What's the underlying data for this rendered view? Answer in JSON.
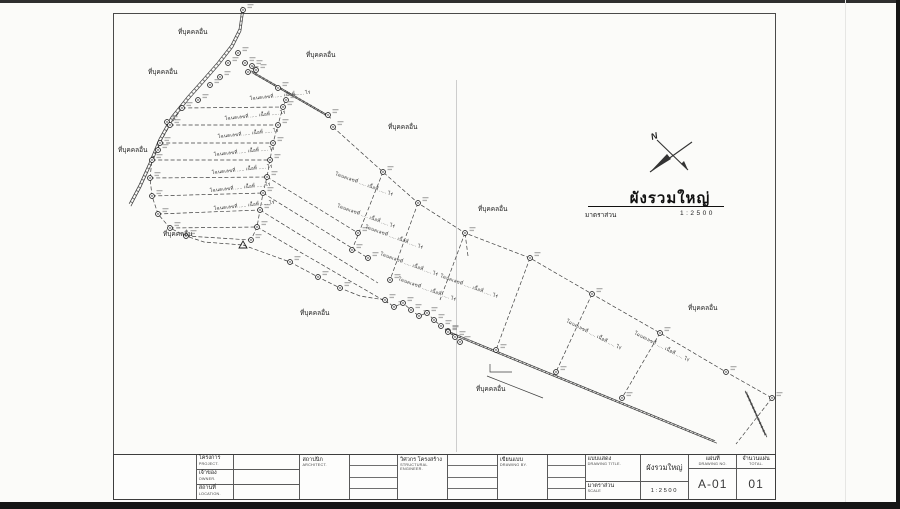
{
  "sheet": {
    "drawing_title": "ผังรวมใหญ่",
    "scale_label": "มาตราส่วน",
    "scale_value": "1:2500",
    "north_label": "N"
  },
  "titleblock": {
    "project_th": "โครงการ",
    "project_en": "PROJECT.",
    "project_value": "",
    "owner_th": "เจ้าของ",
    "owner_en": "OWNER.",
    "owner_value": "",
    "location_th": "สถานที่",
    "location_en": "LOCATION.",
    "location_value": "",
    "architect_th": "สถาปนิก",
    "architect_en": "ARCHITECT.",
    "structural_th": "วิศวกร โครงสร้าง",
    "structural_en": "STRUCTURAL ENGINEER.",
    "drawn_by_th": "เขียนแบบ",
    "drawn_by_en": "DRAWING BY.",
    "drawing_title_th": "แบบแสดง",
    "drawing_title_en": "DRAWING TITLE.",
    "drawing_title_value": "ผังรวมใหญ่",
    "scale_th": "มาตราส่วน",
    "scale_en": "SCALE",
    "scale_value": "1:2500",
    "sheet_no_th": "แผ่นที่",
    "sheet_no_en": "DRAWING NO.",
    "sheet_no_value": "A-01",
    "total_th": "จำนวนแผ่น",
    "total_en": "TOTAL.",
    "total_value": "01"
  },
  "plan": {
    "adjacent_land_label": "ที่บุคคลอื่น",
    "parcel_label_text": "โฉนดเลขที่ ..... เนื้อที่ ..... ไร่",
    "area_labels": [
      [
        178,
        34
      ],
      [
        306,
        57
      ],
      [
        148,
        74
      ],
      [
        118,
        152
      ],
      [
        388,
        129
      ],
      [
        478,
        211
      ],
      [
        163,
        236
      ],
      [
        300,
        315
      ],
      [
        688,
        310
      ],
      [
        476,
        391
      ]
    ],
    "parcel_labels": [
      [
        250,
        100,
        -6
      ],
      [
        225,
        120,
        -6
      ],
      [
        218,
        138,
        -6
      ],
      [
        214,
        156,
        -6
      ],
      [
        212,
        174,
        -6
      ],
      [
        210,
        192,
        -6
      ],
      [
        214,
        210,
        -6
      ],
      [
        335,
        175,
        20
      ],
      [
        337,
        207,
        20
      ],
      [
        365,
        228,
        20
      ],
      [
        380,
        255,
        20
      ],
      [
        398,
        280,
        20
      ],
      [
        440,
        277,
        20
      ],
      [
        566,
        322,
        27
      ],
      [
        634,
        334,
        27
      ]
    ],
    "markers": [
      [
        245,
        63
      ],
      [
        252,
        66
      ],
      [
        248,
        72
      ],
      [
        256,
        70
      ],
      [
        238,
        53
      ],
      [
        228,
        63
      ],
      [
        220,
        77
      ],
      [
        210,
        85
      ],
      [
        198,
        100
      ],
      [
        182,
        108
      ],
      [
        167,
        122
      ],
      [
        158,
        150
      ],
      [
        170,
        125
      ],
      [
        160,
        143
      ],
      [
        152,
        160
      ],
      [
        150,
        178
      ],
      [
        152,
        196
      ],
      [
        158,
        214
      ],
      [
        170,
        228
      ],
      [
        186,
        236
      ],
      [
        286,
        100
      ],
      [
        283,
        107
      ],
      [
        278,
        125
      ],
      [
        273,
        143
      ],
      [
        270,
        160
      ],
      [
        267,
        177
      ],
      [
        263,
        193
      ],
      [
        260,
        210
      ],
      [
        257,
        227
      ],
      [
        251,
        240
      ],
      [
        278,
        88
      ],
      [
        328,
        115
      ],
      [
        333,
        127
      ],
      [
        383,
        172
      ],
      [
        418,
        203
      ],
      [
        465,
        233
      ],
      [
        530,
        258
      ],
      [
        592,
        294
      ],
      [
        660,
        333
      ],
      [
        726,
        372
      ],
      [
        772,
        398
      ],
      [
        358,
        233
      ],
      [
        368,
        258
      ],
      [
        352,
        250
      ],
      [
        390,
        280
      ],
      [
        290,
        262
      ],
      [
        318,
        277
      ],
      [
        340,
        288
      ],
      [
        385,
        300
      ],
      [
        394,
        307
      ],
      [
        403,
        303
      ],
      [
        411,
        310
      ],
      [
        419,
        316
      ],
      [
        427,
        313
      ],
      [
        434,
        320
      ],
      [
        441,
        326
      ],
      [
        448,
        331
      ],
      [
        455,
        337
      ],
      [
        460,
        342
      ],
      [
        496,
        350
      ],
      [
        556,
        372
      ],
      [
        622,
        398
      ],
      [
        448,
        332
      ],
      [
        243,
        10
      ]
    ],
    "triangles": [
      [
        243,
        245
      ]
    ],
    "dashed_lines": [
      [
        [
          333,
          127
        ],
        [
          383,
          172
        ],
        [
          418,
          203
        ],
        [
          465,
          233
        ],
        [
          530,
          258
        ],
        [
          592,
          294
        ],
        [
          660,
          333
        ],
        [
          726,
          372
        ],
        [
          772,
          398
        ]
      ],
      [
        [
          286,
          100
        ],
        [
          283,
          107
        ],
        [
          278,
          125
        ],
        [
          273,
          143
        ],
        [
          270,
          160
        ],
        [
          267,
          177
        ],
        [
          263,
          193
        ],
        [
          260,
          210
        ],
        [
          257,
          227
        ],
        [
          251,
          240
        ]
      ],
      [
        [
          182,
          108
        ],
        [
          283,
          107
        ]
      ],
      [
        [
          170,
          125
        ],
        [
          278,
          125
        ]
      ],
      [
        [
          160,
          143
        ],
        [
          273,
          143
        ]
      ],
      [
        [
          152,
          160
        ],
        [
          270,
          160
        ]
      ],
      [
        [
          150,
          178
        ],
        [
          267,
          177
        ]
      ],
      [
        [
          152,
          196
        ],
        [
          263,
          193
        ]
      ],
      [
        [
          158,
          214
        ],
        [
          260,
          210
        ]
      ],
      [
        [
          170,
          228
        ],
        [
          257,
          227
        ]
      ],
      [
        [
          186,
          236
        ],
        [
          251,
          240
        ]
      ],
      [
        [
          182,
          108
        ],
        [
          170,
          125
        ],
        [
          160,
          143
        ],
        [
          152,
          160
        ],
        [
          150,
          178
        ],
        [
          152,
          196
        ],
        [
          158,
          214
        ],
        [
          170,
          228
        ],
        [
          186,
          236
        ],
        [
          204,
          242
        ],
        [
          243,
          245
        ]
      ],
      [
        [
          267,
          177
        ],
        [
          358,
          233
        ]
      ],
      [
        [
          263,
          193
        ],
        [
          368,
          258
        ]
      ],
      [
        [
          260,
          210
        ],
        [
          378,
          283
        ]
      ],
      [
        [
          257,
          227
        ],
        [
          388,
          303
        ]
      ],
      [
        [
          383,
          172
        ],
        [
          352,
          250
        ]
      ],
      [
        [
          418,
          203
        ],
        [
          390,
          280
        ]
      ],
      [
        [
          465,
          233
        ],
        [
          440,
          300
        ]
      ],
      [
        [
          243,
          245
        ],
        [
          290,
          262
        ],
        [
          318,
          277
        ],
        [
          340,
          288
        ],
        [
          360,
          296
        ],
        [
          385,
          300
        ]
      ],
      [
        [
          385,
          300
        ],
        [
          394,
          307
        ],
        [
          403,
          303
        ],
        [
          411,
          310
        ],
        [
          419,
          316
        ],
        [
          427,
          313
        ],
        [
          434,
          320
        ],
        [
          441,
          326
        ],
        [
          448,
          331
        ],
        [
          455,
          337
        ],
        [
          460,
          342
        ]
      ],
      [
        [
          530,
          258
        ],
        [
          496,
          350
        ]
      ],
      [
        [
          592,
          294
        ],
        [
          556,
          372
        ]
      ],
      [
        [
          660,
          333
        ],
        [
          622,
          398
        ]
      ],
      [
        [
          772,
          398
        ],
        [
          736,
          444
        ]
      ],
      [
        [
          468,
          256
        ],
        [
          465,
          233
        ]
      ]
    ],
    "double_lines": [
      [
        [
          243,
          8
        ],
        [
          240,
          30
        ],
        [
          232,
          46
        ],
        [
          218,
          64
        ],
        [
          204,
          80
        ],
        [
          188,
          98
        ],
        [
          172,
          118
        ],
        [
          160,
          140
        ],
        [
          150,
          164
        ],
        [
          140,
          186
        ],
        [
          130,
          205
        ]
      ],
      [
        [
          252,
          72
        ],
        [
          330,
          117
        ]
      ],
      [
        [
          448,
          332
        ],
        [
          716,
          442
        ]
      ],
      [
        [
          746,
          392
        ],
        [
          766,
          436
        ]
      ]
    ],
    "thin_lines": [
      [
        [
          490,
          364
        ],
        [
          490,
          372
        ],
        [
          512,
          372
        ]
      ],
      [
        [
          487,
          376
        ],
        [
          543,
          398
        ]
      ]
    ]
  }
}
